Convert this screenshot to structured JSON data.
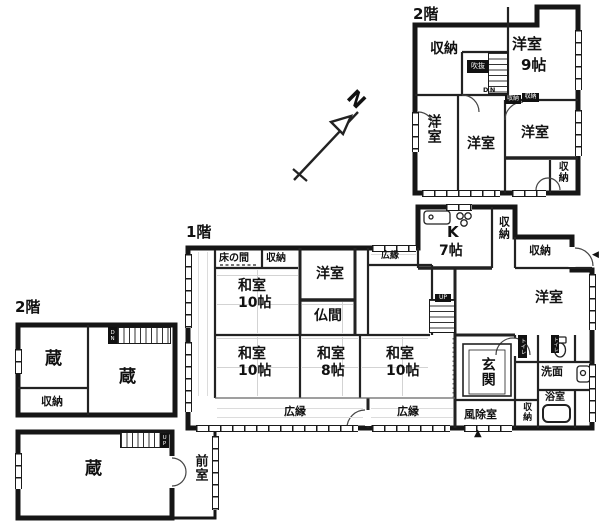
{
  "colors": {
    "background": "#ffffff",
    "wall": "#1a1a1a",
    "thin_line": "#555555"
  },
  "compass": {
    "north": "N"
  },
  "main_2f": {
    "floor_label": "2階",
    "storage_nw": "収納",
    "western_9_name": "洋室",
    "western_9_size": "9帖",
    "void_label": "吹抜",
    "stairs_down": "DN",
    "closet_a": "収納",
    "closet_b": "収納",
    "western_w": "洋室",
    "western_c": "洋室",
    "western_e": "洋室",
    "storage_se": "収納"
  },
  "main_1f": {
    "floor_label": "1階",
    "tokonoma": "床の間",
    "storage_n": "収納",
    "washitsu_ne_name": "和室",
    "washitsu_ne_size": "10帖",
    "western_n": "洋室",
    "butsuma": "仏間",
    "hiroen_n": "広縁",
    "kitchen_name": "K",
    "kitchen_size": "7帖",
    "storage_v1": "収納",
    "storage_e": "収納",
    "western_e": "洋室",
    "stairs_up": "UP",
    "washitsu_sw_name": "和室",
    "washitsu_sw_size": "10帖",
    "washitsu_s_name": "和室",
    "washitsu_s_size": "8帖",
    "washitsu_se_name": "和室",
    "washitsu_se_size": "10帖",
    "genkan": "玄関",
    "hiroen_sw": "広縁",
    "hiroen_se": "広縁",
    "windbreak": "風除室",
    "storage_s": "収納",
    "toilet_a": "トイレ",
    "toilet_b": "トイレ",
    "washroom": "洗面",
    "bathroom": "浴室",
    "entrance_marker_s": "▲",
    "entrance_marker_e": "◀"
  },
  "kura_2f": {
    "floor_label": "2階",
    "kura_w": "蔵",
    "kura_e": "蔵",
    "storage": "収納",
    "stairs_down": "DN"
  },
  "kura_1f": {
    "kura": "蔵",
    "stairs_up": "UP",
    "anteroom": "前室"
  }
}
